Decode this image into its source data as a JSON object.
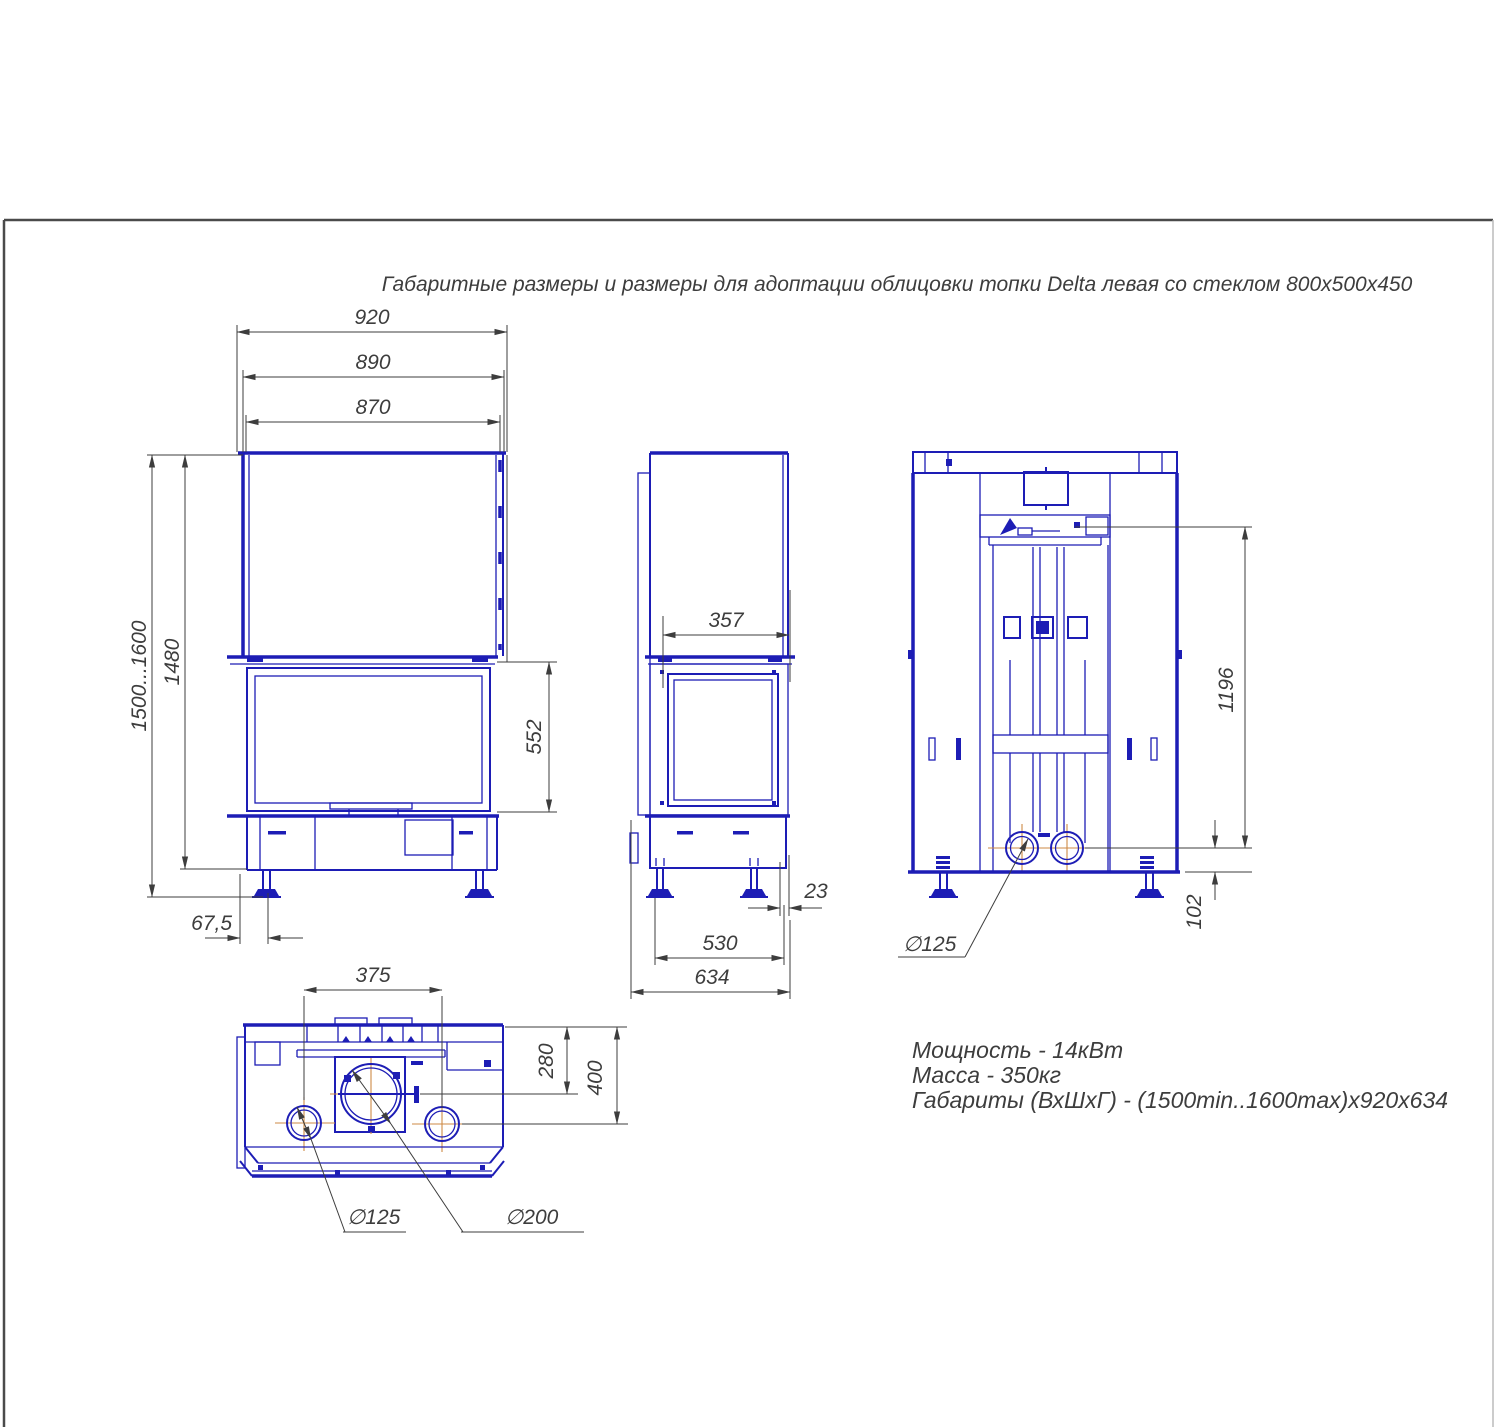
{
  "page": {
    "title": "Габаритные размеры и размеры для адоптации облицовки топки Delta левая со стеклом 800х500х450"
  },
  "specs": {
    "line1": "Мощность - 14кВт",
    "line2": "Масса - 350кг",
    "line3": "Габариты (ВхШхГ) - (1500min..1600max)х920х634"
  },
  "dims": {
    "front": {
      "w_outer": "920",
      "w_mid": "890",
      "w_glass": "870",
      "h_range": "1500...1600",
      "h_body": "1480",
      "h_door": "552",
      "leg_offset": "67,5"
    },
    "side": {
      "d_glass": "357",
      "gap": "23",
      "leg_span": "530",
      "d_total": "634"
    },
    "rear": {
      "h_collar": "1196",
      "h_pipe": "102",
      "pipe_dia": "∅125"
    },
    "top": {
      "pipe_spacing": "375",
      "flue_depth": "280",
      "pipe_depth": "400",
      "pipe_dia": "∅125",
      "flue_dia": "∅200"
    }
  },
  "colors": {
    "drawing_line": "#1d1db5",
    "dimension_line": "#3d3d3d",
    "centerline": "#cd8a45",
    "frame": "#4a4a4a",
    "background": "#ffffff"
  }
}
